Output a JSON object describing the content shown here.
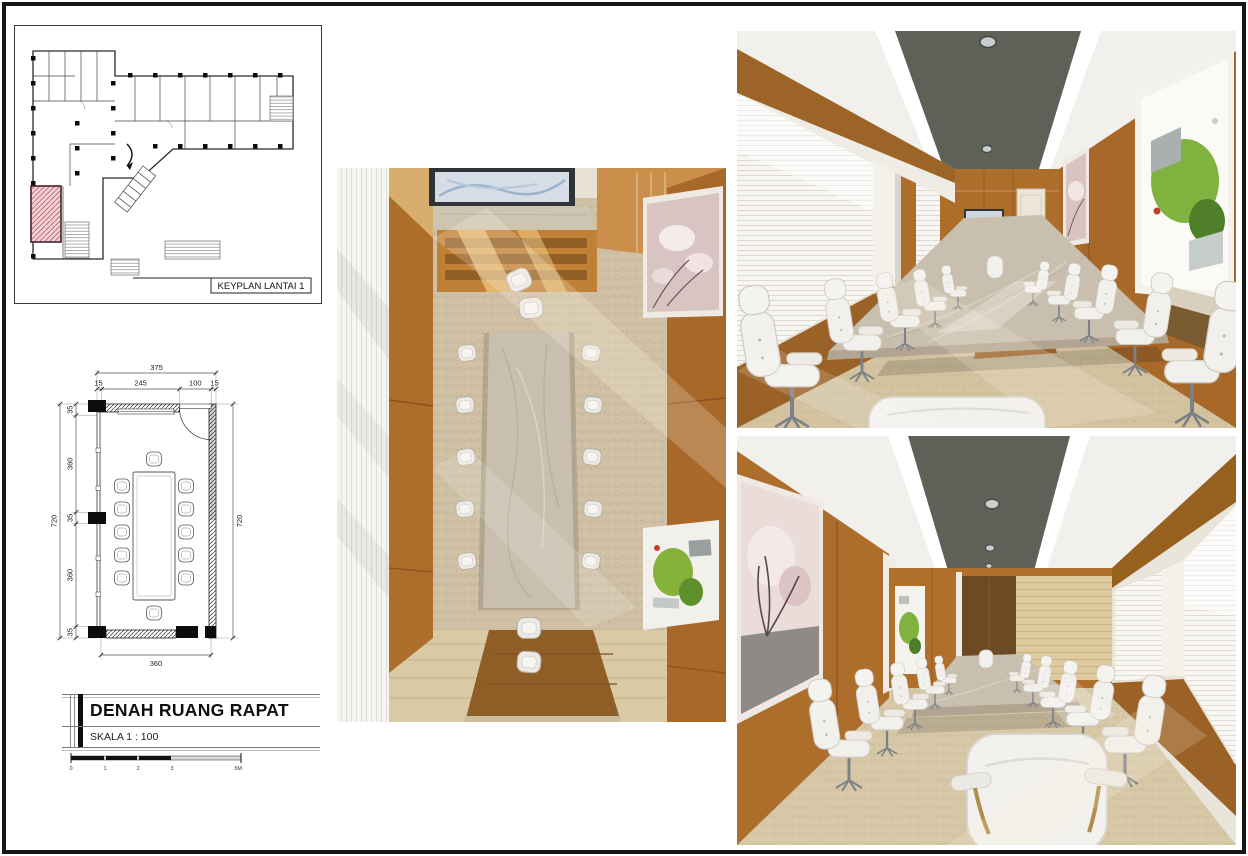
{
  "sheet": {
    "background": "#ffffff",
    "border_color": "#161616"
  },
  "keyplan": {
    "label": "KEYPLAN LANTAI 1",
    "highlight_hatch": "#c2606e"
  },
  "floorplan": {
    "width_total": "375",
    "width_segments": [
      "15",
      "245",
      "100",
      "15"
    ],
    "height_total_left": "720",
    "height_segments": [
      "35",
      "360",
      "35",
      "360",
      "35"
    ],
    "height_total_right": "720",
    "bottom_width": "360"
  },
  "titleblock": {
    "title": "DENAH RUANG RAPAT",
    "scale_label": "SKALA 1 : 100",
    "scalebar_labels": [
      "0",
      "1",
      "2",
      "3",
      "5M"
    ]
  },
  "palette": {
    "wood": "#ad6d2b",
    "wood_deep": "#9a6226",
    "wood_light": "#d8ae6f",
    "ceiling_band": "#5d6157",
    "marble": "#c9bfae",
    "carpet": "#d2c2a2",
    "chair_white": "#f1f0ec",
    "blinds": "#f6f5f1",
    "art_pink": "#d9c2c2",
    "art_green": "#7fb23e",
    "tv_frame": "#2f3437"
  }
}
